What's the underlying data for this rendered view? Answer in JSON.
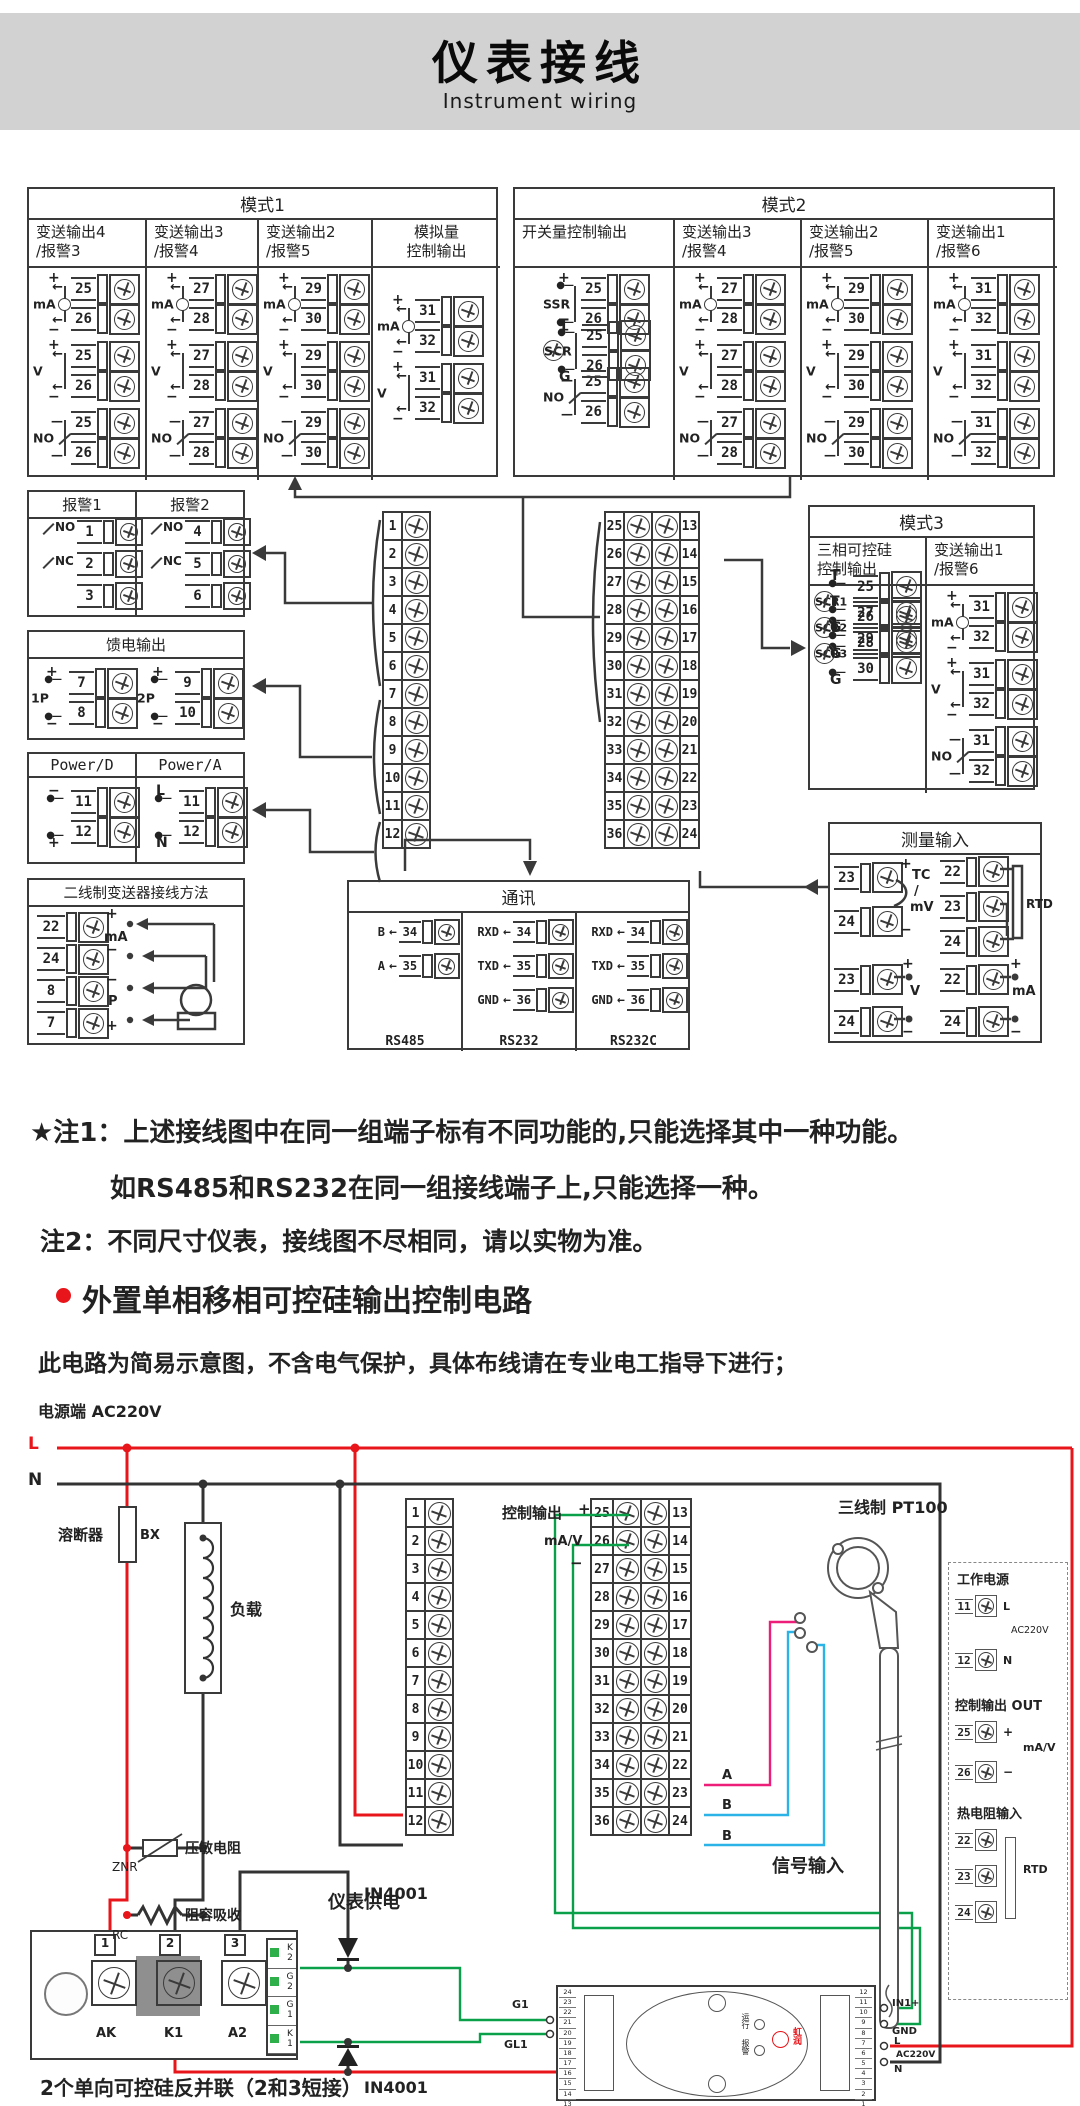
{
  "header": {
    "title": "仪表接线",
    "subtitle": "Instrument wiring"
  },
  "nums1_12": [
    "1",
    "2",
    "3",
    "4",
    "5",
    "6",
    "7",
    "8",
    "9",
    "10",
    "11",
    "12"
  ],
  "pairs": [
    {
      "a": "25",
      "b": "13"
    },
    {
      "a": "26",
      "b": "14"
    },
    {
      "a": "27",
      "b": "15"
    },
    {
      "a": "28",
      "b": "16"
    },
    {
      "a": "29",
      "b": "17"
    },
    {
      "a": "30",
      "b": "18"
    },
    {
      "a": "31",
      "b": "19"
    },
    {
      "a": "32",
      "b": "20"
    },
    {
      "a": "33",
      "b": "21"
    },
    {
      "a": "34",
      "b": "22"
    },
    {
      "a": "35",
      "b": "23"
    },
    {
      "a": "36",
      "b": "24"
    }
  ],
  "mode1": {
    "title": "模式1",
    "cols": [
      {
        "t1": "变送输出4",
        "t2": "/报警3",
        "groups": [
          {
            "type": "ma",
            "sym": "mA",
            "p1": "+",
            "p2": "−",
            "n1": "25",
            "n2": "26"
          },
          {
            "type": "v",
            "sym": "V",
            "p1": "+",
            "p2": "−",
            "n1": "25",
            "n2": "26"
          },
          {
            "type": "no",
            "sym": "NO",
            "n1": "25",
            "n2": "26"
          }
        ]
      },
      {
        "t1": "变送输出3",
        "t2": "/报警4",
        "groups": [
          {
            "type": "ma",
            "sym": "mA",
            "p1": "+",
            "p2": "−",
            "n1": "27",
            "n2": "28"
          },
          {
            "type": "v",
            "sym": "V",
            "p1": "+",
            "p2": "−",
            "n1": "27",
            "n2": "28"
          },
          {
            "type": "no",
            "sym": "NO",
            "n1": "27",
            "n2": "28"
          }
        ]
      },
      {
        "t1": "变送输出2",
        "t2": "/报警5",
        "groups": [
          {
            "type": "ma",
            "sym": "mA",
            "p1": "+",
            "p2": "−",
            "n1": "29",
            "n2": "30"
          },
          {
            "type": "v",
            "sym": "V",
            "p1": "+",
            "p2": "−",
            "n1": "29",
            "n2": "30"
          },
          {
            "type": "no",
            "sym": "NO",
            "n1": "29",
            "n2": "30"
          }
        ]
      },
      {
        "t1": "模拟量",
        "t2": "控制输出",
        "groups": [
          {
            "type": "ma",
            "sym": "mA",
            "p1": "+",
            "p2": "−",
            "n1": "31",
            "n2": "32"
          },
          {
            "type": "v",
            "sym": "V",
            "p1": "+",
            "p2": "−",
            "n1": "31",
            "n2": "32"
          }
        ]
      }
    ]
  },
  "mode2": {
    "title": "模式2",
    "cols": [
      {
        "t1": "开关量控制输出",
        "t2": "",
        "groups": [
          {
            "type": "ssr",
            "sym": "SSR",
            "p1": "+",
            "p2": "−",
            "n1": "25",
            "n2": "26"
          },
          {
            "type": "scr",
            "sym": "SCR",
            "p1": "T",
            "p2": "G",
            "n1": "25",
            "n2": "26"
          },
          {
            "type": "no",
            "sym": "NO",
            "n1": "25",
            "n2": "26"
          }
        ]
      },
      {
        "t1": "变送输出3",
        "t2": "/报警4",
        "groups": [
          {
            "type": "ma",
            "sym": "mA",
            "p1": "+",
            "p2": "−",
            "n1": "27",
            "n2": "28"
          },
          {
            "type": "v",
            "sym": "V",
            "p1": "+",
            "p2": "−",
            "n1": "27",
            "n2": "28"
          },
          {
            "type": "no",
            "sym": "NO",
            "n1": "27",
            "n2": "28"
          }
        ]
      },
      {
        "t1": "变送输出2",
        "t2": "/报警5",
        "groups": [
          {
            "type": "ma",
            "sym": "mA",
            "p1": "+",
            "p2": "−",
            "n1": "29",
            "n2": "30"
          },
          {
            "type": "v",
            "sym": "V",
            "p1": "+",
            "p2": "−",
            "n1": "29",
            "n2": "30"
          },
          {
            "type": "no",
            "sym": "NO",
            "n1": "29",
            "n2": "30"
          }
        ]
      },
      {
        "t1": "变送输出1",
        "t2": "/报警6",
        "groups": [
          {
            "type": "ma",
            "sym": "mA",
            "p1": "+",
            "p2": "−",
            "n1": "31",
            "n2": "32"
          },
          {
            "type": "v",
            "sym": "V",
            "p1": "+",
            "p2": "−",
            "n1": "31",
            "n2": "32"
          },
          {
            "type": "no",
            "sym": "NO",
            "n1": "31",
            "n2": "32"
          }
        ]
      }
    ]
  },
  "alarms": {
    "c1": {
      "title": "报警1",
      "n1": "1",
      "n2": "2",
      "n3": "3",
      "no": "NO",
      "nc": "NC"
    },
    "c2": {
      "title": "报警2",
      "n1": "4",
      "n2": "5",
      "n3": "6",
      "no": "NO",
      "nc": "NC"
    }
  },
  "feed": {
    "title": "馈电输出",
    "groups": [
      {
        "type": "ssr",
        "sym": "1P",
        "p1": "+",
        "p2": "−",
        "n1": "7",
        "n2": "8"
      },
      {
        "type": "ssr",
        "sym": "2P",
        "p1": "+",
        "p2": "−",
        "n1": "9",
        "n2": "10"
      }
    ]
  },
  "power": {
    "t1": "Power/D",
    "t2": "Power/A",
    "g1": {
      "type": "ssr",
      "sym": "",
      "p1": "−",
      "p2": "+",
      "n1": "11",
      "n2": "12"
    },
    "g2": {
      "type": "ssr",
      "sym": "",
      "p1": "L",
      "p2": "N",
      "n1": "11",
      "n2": "12"
    }
  },
  "twowire": {
    "title": "二线制变送器接线方法",
    "rows": [
      "22",
      "24",
      "8",
      "7"
    ],
    "l1": "+",
    "lma": "mA",
    "l2": "−",
    "l3": "−",
    "lp": "P",
    "l4": "+"
  },
  "mode3": {
    "title": "模式3",
    "col1": {
      "t1": "三相可控硅",
      "t2": "控制输出",
      "groups": [
        {
          "type": "scr",
          "sym": "SCR1",
          "p1": "T",
          "p2": "G",
          "n1": "25",
          "n2": "26"
        },
        {
          "type": "scr",
          "sym": "SCR2",
          "p1": "T",
          "p2": "G",
          "n1": "27",
          "n2": "28"
        },
        {
          "type": "scr",
          "sym": "SCR3",
          "p1": "T",
          "p2": "G",
          "n1": "29",
          "n2": "30"
        }
      ]
    },
    "col2": {
      "t1": "变送输出1",
      "t2": "/报警6",
      "groups": [
        {
          "type": "ma",
          "sym": "mA",
          "p1": "+",
          "p2": "−",
          "n1": "31",
          "n2": "32"
        },
        {
          "type": "v",
          "sym": "V",
          "p1": "+",
          "p2": "−",
          "n1": "31",
          "n2": "32"
        },
        {
          "type": "no",
          "sym": "NO",
          "n1": "31",
          "n2": "32"
        }
      ]
    }
  },
  "measure": {
    "title": "测量输入",
    "tc": {
      "n1": "23",
      "n2": "24",
      "p1": "+",
      "p2": "−",
      "l1": "TC",
      "l2": "/",
      "l3": "mV"
    },
    "rtd": {
      "n1": "22",
      "n2": "23",
      "n3": "24",
      "lbl": "RTD"
    },
    "v": {
      "n1": "23",
      "n2": "24",
      "p1": "+",
      "p2": "−",
      "lbl": "V"
    },
    "ma": {
      "n1": "22",
      "n2": "24",
      "p1": "+",
      "p2": "−",
      "lbl": "mA"
    }
  },
  "comm": {
    "title": "通讯",
    "s1": {
      "rows": [
        {
          "l": "B",
          "n": "34"
        },
        {
          "l": "A",
          "n": "35"
        }
      ],
      "name": "RS485"
    },
    "s2": {
      "rows": [
        {
          "l": "RXD",
          "n": "34"
        },
        {
          "l": "TXD",
          "n": "35"
        },
        {
          "l": "GND",
          "n": "36"
        }
      ],
      "name": "RS232"
    },
    "s3": {
      "rows": [
        {
          "l": "RXD",
          "n": "34"
        },
        {
          "l": "TXD",
          "n": "35"
        },
        {
          "l": "GND",
          "n": "36"
        }
      ],
      "name": "RS232C"
    }
  },
  "notes": {
    "n1": "★注1：上述接线图中在同一组端子标有不同功能的,只能选择其中一种功能。",
    "n2": "如RS485和RS232在同一组接线端子上,只能选择一种。",
    "n3": "注2：不同尺寸仪表，接线图不尽相同，请以实物为准。"
  },
  "section": {
    "heading": "外置单相移相可控硅输出控制电路",
    "caption": "此电路为简易示意图，不含电气保护，具体布线请在专业电工指导下进行；"
  },
  "circuit": {
    "supply": "电源端  AC220V",
    "l": "L",
    "n": "N",
    "fuse": "溶断器",
    "bx": "BX",
    "load": "负载",
    "varistor": "压敏电阻",
    "znr": "ZNR",
    "rcname": "阻容吸收",
    "rc": "RC",
    "meter_supply": "仪表供电",
    "ctrl": "控制输出",
    "plus": "+",
    "mav": "mA/V",
    "minus": "−",
    "a": "A",
    "b1": "B",
    "b2": "B",
    "signal": "信号输入",
    "pt100": "三线制 PT100",
    "d1": "IN4001",
    "d2": "IN4001",
    "module_caption": "2个单向可控硅反并联（2和3短接）",
    "module": {
      "n1": "1",
      "n2": "2",
      "n3": "3",
      "ak": "AK",
      "k1": "K1",
      "a2": "A2",
      "conn": [
        "K2",
        "G2",
        "G1",
        "K1"
      ]
    },
    "board": {
      "g1": "G1",
      "gl1": "GL1",
      "left_nums": [
        "24",
        "23",
        "22",
        "21",
        "20",
        "19",
        "18",
        "17",
        "16",
        "15",
        "14",
        "13"
      ],
      "right_nums": [
        "12",
        "11",
        "10",
        "9",
        "8",
        "7",
        "6",
        "5",
        "4",
        "3",
        "2",
        "1"
      ],
      "run": "运行",
      "alarm": "报警",
      "brand": "虹润",
      "in1": "IN1+",
      "gnd": "GND",
      "l": "L",
      "ac": "AC220V",
      "n": "N"
    },
    "legend": {
      "t1": "工作电源",
      "r11": "11",
      "r11l": "L",
      "r12": "12",
      "r12l": "N",
      "ac": "AC220V",
      "t2": "控制输出 OUT",
      "r25": "25",
      "r25l": "+",
      "r26": "26",
      "r26l": "−",
      "sig": "mA/V",
      "t3": "热电阻输入",
      "r22": "22",
      "r23": "23",
      "r24": "24",
      "rtd": "RTD"
    }
  }
}
